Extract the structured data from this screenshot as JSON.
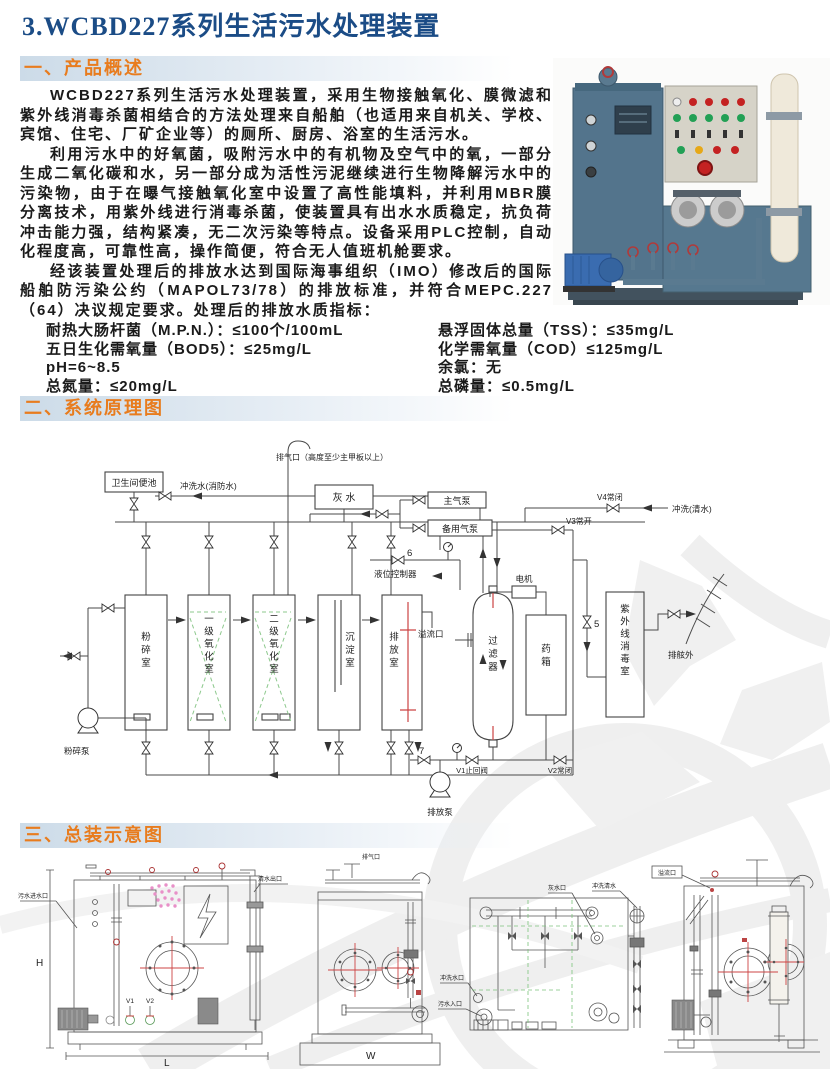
{
  "page": {
    "title": "3.WCBD227系列生活污水处理装置"
  },
  "colors": {
    "title_blue": "#1b4c86",
    "accent_orange": "#e87c1e",
    "drawing_red": "#cc4444",
    "packing_green": "#8cc88c",
    "dot_pink": "#e890c8"
  },
  "overview": {
    "heading": "一、产品概述",
    "p1": "WCBD227系列生活污水处理装置，采用生物接触氧化、膜微滤和紫外线消毒杀菌相结合的方法处理来自船舶（也适用来自机关、学校、宾馆、住宅、厂矿企业等）的厕所、厨房、浴室的生活污水。",
    "p2": "利用污水中的好氧菌，吸附污水中的有机物及空气中的氧，一部分生成二氧化碳和水，另一部分成为活性污泥继续进行生物降解污水中的污染物，由于在曝气接触氧化室中设置了高性能填料，并利用MBR膜分离技术，用紫外线进行消毒杀菌，使装置具有出水水质稳定，抗负荷冲击能力强，结构紧凑，无二次污染等特点。设备采用PLC控制，自动化程度高，可靠性高，操作简便，符合无人值班机舱要求。",
    "p3": "经该装置处理后的排放水达到国际海事组织（IMO）修改后的国际船舶防污染公约（MAPOL73/78）的排放标准，并符合MEPC.227（64）决议规定要求。处理后的排放水质指标：",
    "specs_left": [
      "耐热大肠杆菌（M.P.N.）：≤100个/100mL",
      "五日生化需氧量（BOD5）：≤25mg/L",
      "pH=6~8.5",
      "总氮量：≤20mg/L"
    ],
    "specs_right": [
      "悬浮固体总量（TSS）：≤35mg/L",
      "化学需氧量（COD）≤125mg/L",
      "余氯：无",
      "总磷量：≤0.5mg/L"
    ]
  },
  "schematic": {
    "heading": "二、系统原理图",
    "labels": {
      "exhaust": "排气口（高度至少主甲板以上）",
      "toilet": "卫生间便池",
      "flush_fire": "冲洗水(消防水)",
      "gray_water": "灰  水",
      "main_air_pump": "主气泵",
      "backup_air_pump": "备用气泵",
      "v4": "V4常闭",
      "flush_clean": "冲洗(清水)",
      "v3": "V3常开",
      "level_controller": "液位控制器",
      "motor": "电机",
      "overflow": "溢流口",
      "tank_crush": "粉碎室",
      "tank_ox1": "一级氧化室",
      "tank_ox2": "二级氧化室",
      "tank_sed": "沉淀室",
      "tank_dis": "排放室",
      "filter": "过滤器",
      "chem_tank": "药箱",
      "uv_room": "紫外线消毒室",
      "crush_pump": "粉碎泵",
      "discharge_pump": "排放泵",
      "v1": "V1止回阀",
      "v2": "V2常闭",
      "overboard": "排舷外",
      "n5": "5",
      "n6": "6",
      "n7": "7"
    }
  },
  "assembly": {
    "heading": "三、总装示意图",
    "d1": {
      "inlet": "污水进水口",
      "outlet": "清水出口",
      "v1": "V1",
      "v2": "V2",
      "dim_h": "H",
      "dim_l": "L"
    },
    "d2": {
      "vent": "排气口",
      "dim_w": "W"
    },
    "d3": {
      "gray": "灰水口",
      "flush_clean": "冲洗清水",
      "flush": "冲洗水口",
      "inlet": "污水入口"
    },
    "d4": {
      "overflow": "溢流口"
    }
  }
}
